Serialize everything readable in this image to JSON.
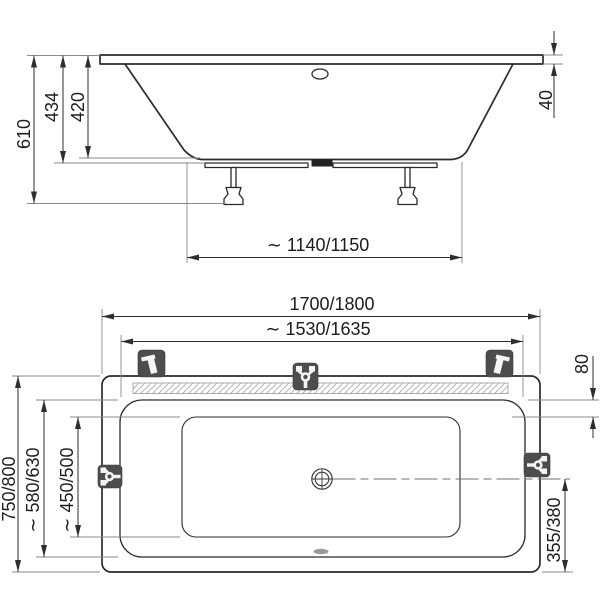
{
  "drawing": {
    "type": "bathtub installation dimension drawing",
    "views": {
      "top": "side-elevation",
      "bottom": "top-plan"
    }
  },
  "colors": {
    "line": "#2b2b2b",
    "dim_text": "#1c1c1c",
    "icon_background": "#4d4d4d",
    "icon_glyph": "#f4f4f4",
    "hatch": "#b3b3b3"
  },
  "side_view": {
    "dims": {
      "total_height": "610",
      "shell_height": "434",
      "inner_depth": "420",
      "rim_thickness": "40",
      "base_length": "∼ 1140/1150"
    }
  },
  "plan_view": {
    "dims": {
      "outer_length": "1700/1800",
      "inner_length": "∼ 1530/1635",
      "outer_width": "750/800",
      "inner_width": "∼ 580/630",
      "floor_width": "∼ 450/500",
      "rim_ledge": "80",
      "drain_to_end": "355/380"
    },
    "icons": [
      "faucet-position-top-left",
      "faucet-position-top-center",
      "faucet-position-top-right",
      "faucet-position-side-left",
      "faucet-position-side-right"
    ]
  }
}
